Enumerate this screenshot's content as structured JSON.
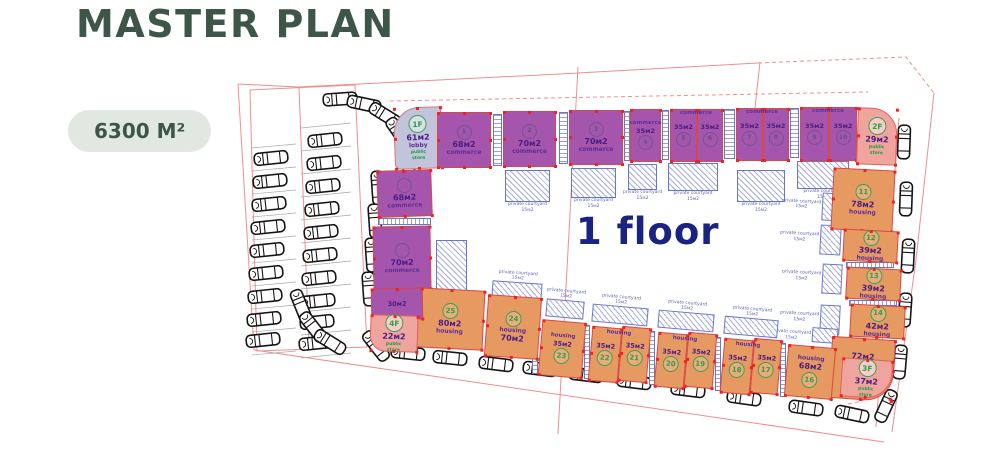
{
  "title": "MASTER PLAN",
  "area_badge": "6300 M²",
  "floor_label": "1 floor",
  "colors": {
    "title_green": "#3e5648",
    "badge_bg": "#e1e8e1",
    "commerce_purple": "#a655ad",
    "housing_orange": "#e69a61",
    "store_pink": "#f0a49e",
    "lobby_gray": "#c2c4dc",
    "circle_green": "#3aa24c",
    "plan_line_red": "#ef8f8f",
    "marker_red": "#ee2222",
    "courtyard_blue": "#6a76c8",
    "floor_text_blue": "#1b2380"
  },
  "plan": {
    "courtyard_label": "private courtyard",
    "courtyard_sub": "15м2",
    "units": [
      {
        "id": "lobby",
        "type": "lobby",
        "x": 394,
        "y": 107,
        "w": 48,
        "h": 62,
        "r": -2,
        "br": "26px 2px 2px 6px",
        "items": [
          [
            "1F",
            "circle-floor"
          ],
          [
            "61м2",
            "area"
          ],
          [
            "lobby",
            "use"
          ],
          [
            "public store",
            "store"
          ]
        ]
      },
      {
        "id": "c-left-68",
        "type": "commerce",
        "x": 377,
        "y": 170,
        "w": 55,
        "h": 47,
        "r": -2,
        "items": [
          [
            "",
            "circle-faint"
          ],
          [
            "68м2",
            "area"
          ],
          [
            "commerce",
            "use"
          ]
        ]
      },
      {
        "id": "c-left-70",
        "type": "commerce",
        "x": 373,
        "y": 226,
        "w": 58,
        "h": 64,
        "r": -1,
        "items": [
          [
            "",
            "circle-faint"
          ],
          [
            "70м2",
            "area"
          ],
          [
            "commerce",
            "use"
          ]
        ]
      },
      {
        "id": "c1",
        "type": "commerce",
        "x": 437,
        "y": 112,
        "w": 54,
        "h": 56,
        "items": [
          [
            "1",
            "circle-faint"
          ],
          [
            "68м2",
            "area"
          ],
          [
            "commerce",
            "use"
          ]
        ]
      },
      {
        "id": "c2",
        "type": "commerce",
        "x": 503,
        "y": 111,
        "w": 53,
        "h": 56,
        "items": [
          [
            "2",
            "circle-faint"
          ],
          [
            "70м2",
            "area"
          ],
          [
            "commerce",
            "use"
          ]
        ]
      },
      {
        "id": "c3",
        "type": "commerce",
        "x": 569,
        "y": 110,
        "w": 54,
        "h": 55,
        "items": [
          [
            "3",
            "circle-faint"
          ],
          [
            "70м2",
            "area"
          ],
          [
            "commerce",
            "use"
          ]
        ]
      },
      {
        "id": "c4",
        "type": "commerce",
        "x": 630,
        "y": 109,
        "w": 31,
        "h": 53,
        "items": [
          [
            "commerce",
            "use-sm"
          ],
          [
            "35м2",
            "area-sm"
          ],
          [
            "4",
            "circle-faint"
          ]
        ]
      },
      {
        "id": "c5",
        "type": "commerce",
        "x": 670,
        "y": 109,
        "w": 27,
        "h": 53,
        "items": [
          [
            "35м2",
            "area-sm"
          ],
          [
            "5",
            "circle-faint"
          ]
        ]
      },
      {
        "id": "c6",
        "type": "commerce",
        "x": 697,
        "y": 109,
        "w": 26,
        "h": 53,
        "items": [
          [
            "35м2",
            "area-sm"
          ],
          [
            "6",
            "circle-faint"
          ]
        ]
      },
      {
        "id": "c7",
        "type": "commerce",
        "x": 736,
        "y": 108,
        "w": 27,
        "h": 53,
        "items": [
          [
            "35м2",
            "area-sm"
          ],
          [
            "7",
            "circle-faint"
          ]
        ]
      },
      {
        "id": "c8",
        "type": "commerce",
        "x": 763,
        "y": 108,
        "w": 26,
        "h": 53,
        "items": [
          [
            "35м2",
            "area-sm"
          ],
          [
            "8",
            "circle-faint"
          ]
        ]
      },
      {
        "id": "c9",
        "type": "commerce",
        "x": 800,
        "y": 107,
        "w": 29,
        "h": 54,
        "items": [
          [
            "35м2",
            "area-sm"
          ],
          [
            "9",
            "circle-faint"
          ]
        ]
      },
      {
        "id": "c10",
        "type": "commerce",
        "x": 829,
        "y": 107,
        "w": 28,
        "h": 54,
        "items": [
          [
            "35м2",
            "area-sm"
          ],
          [
            "10",
            "circle-faint"
          ]
        ]
      },
      {
        "id": "store-2f",
        "type": "store",
        "x": 857,
        "y": 108,
        "w": 40,
        "h": 57,
        "r": 2,
        "br": "2px 26px 2px 2px",
        "items": [
          [
            "2F",
            "circle-floor"
          ],
          [
            "29м2",
            "area"
          ],
          [
            "public store",
            "store"
          ]
        ]
      },
      {
        "id": "h11",
        "type": "housing",
        "x": 832,
        "y": 169,
        "w": 62,
        "h": 62,
        "r": 3,
        "items": [
          [
            "11",
            "circle"
          ],
          [
            "78м2",
            "area"
          ],
          [
            "housing",
            "use"
          ]
        ]
      },
      {
        "id": "h12",
        "type": "housing",
        "x": 843,
        "y": 230,
        "w": 55,
        "h": 32,
        "r": 3,
        "items": [
          [
            "12",
            "circle"
          ],
          [
            "39м2",
            "area"
          ],
          [
            "housing",
            "use"
          ]
        ]
      },
      {
        "id": "h13",
        "type": "housing",
        "x": 846,
        "y": 268,
        "w": 55,
        "h": 32,
        "r": 3,
        "items": [
          [
            "13",
            "circle"
          ],
          [
            "39м2",
            "area"
          ],
          [
            "housing",
            "use"
          ]
        ]
      },
      {
        "id": "h14",
        "type": "housing",
        "x": 850,
        "y": 305,
        "w": 55,
        "h": 33,
        "r": 3,
        "items": [
          [
            "14",
            "circle"
          ],
          [
            "42м2",
            "area"
          ],
          [
            "housing",
            "use"
          ]
        ]
      },
      {
        "id": "h15",
        "type": "housing",
        "x": 830,
        "y": 338,
        "w": 64,
        "h": 62,
        "r": 4,
        "br": "2px 2px 28px 2px",
        "items": [
          [
            "72м2",
            "area"
          ],
          [
            "15",
            "circle"
          ],
          [
            "housing",
            "use"
          ]
        ]
      },
      {
        "id": "store-3f",
        "type": "store",
        "x": 841,
        "y": 359,
        "w": 51,
        "h": 39,
        "r": 4,
        "br": "2px 2px 26px 2px",
        "items": [
          [
            "3F",
            "circle-floor"
          ],
          [
            "37м2",
            "area"
          ],
          [
            "public store",
            "store"
          ]
        ]
      },
      {
        "id": "h16",
        "type": "housing",
        "x": 786,
        "y": 346,
        "w": 48,
        "h": 52,
        "r": 5,
        "items": [
          [
            "housing",
            "use"
          ],
          [
            "68м2",
            "area"
          ],
          [
            "16",
            "circle"
          ]
        ]
      },
      {
        "id": "h17",
        "type": "housing",
        "x": 752,
        "y": 339,
        "w": 28,
        "h": 55,
        "r": 5,
        "items": [
          [
            "35м2",
            "area-sm"
          ],
          [
            "17",
            "circle"
          ]
        ]
      },
      {
        "id": "h18",
        "type": "housing",
        "x": 722,
        "y": 339,
        "w": 30,
        "h": 55,
        "r": 5,
        "items": [
          [
            "35м2",
            "area-sm"
          ],
          [
            "18",
            "circle"
          ]
        ]
      },
      {
        "id": "h19",
        "type": "housing",
        "x": 686,
        "y": 333,
        "w": 29,
        "h": 55,
        "r": 5,
        "items": [
          [
            "35м2",
            "area-sm"
          ],
          [
            "19",
            "circle"
          ]
        ]
      },
      {
        "id": "h20",
        "type": "housing",
        "x": 656,
        "y": 333,
        "w": 30,
        "h": 55,
        "r": 5,
        "items": [
          [
            "35м2",
            "area-sm"
          ],
          [
            "20",
            "circle"
          ]
        ]
      },
      {
        "id": "h21",
        "type": "housing",
        "x": 620,
        "y": 327,
        "w": 29,
        "h": 55,
        "r": 5,
        "items": [
          [
            "35м2",
            "area-sm"
          ],
          [
            "21",
            "circle"
          ]
        ]
      },
      {
        "id": "h22",
        "type": "housing",
        "x": 590,
        "y": 327,
        "w": 30,
        "h": 55,
        "r": 5,
        "items": [
          [
            "35м2",
            "area-sm"
          ],
          [
            "22",
            "circle"
          ]
        ]
      },
      {
        "id": "h23",
        "type": "housing",
        "x": 540,
        "y": 321,
        "w": 44,
        "h": 56,
        "r": 5,
        "items": [
          [
            "housing",
            "use-sm"
          ],
          [
            "35м2",
            "area-sm"
          ],
          [
            "23",
            "circle"
          ]
        ]
      },
      {
        "id": "h24",
        "type": "housing",
        "x": 486,
        "y": 296,
        "w": 54,
        "h": 62,
        "r": 4,
        "items": [
          [
            "24",
            "circle"
          ],
          [
            "housing",
            "use"
          ],
          [
            "70м2",
            "area"
          ]
        ]
      },
      {
        "id": "h25",
        "type": "housing",
        "x": 416,
        "y": 289,
        "w": 68,
        "h": 60,
        "r": 3,
        "items": [
          [
            "25",
            "circle"
          ],
          [
            "80м2",
            "area"
          ],
          [
            "housing",
            "use"
          ]
        ]
      },
      {
        "id": "c-left-30",
        "type": "commerce",
        "x": 371,
        "y": 288,
        "w": 52,
        "h": 32,
        "r": -1,
        "items": [
          [
            "30м2",
            "area-sm"
          ]
        ]
      },
      {
        "id": "store-4f",
        "type": "store",
        "x": 370,
        "y": 315,
        "w": 48,
        "h": 37,
        "r": 2,
        "br": "2px 2px 2px 16px",
        "items": [
          [
            "4F",
            "circle-floor"
          ],
          [
            "22м2",
            "area"
          ],
          [
            "public store",
            "store"
          ]
        ]
      }
    ],
    "labels": [
      {
        "t": "commerce",
        "x": 696,
        "y": 110,
        "r": 0,
        "cls": "use-sm"
      },
      {
        "t": "commerce",
        "x": 762,
        "y": 109,
        "r": 0,
        "cls": "use-sm"
      },
      {
        "t": "commerce",
        "x": 828,
        "y": 108,
        "r": 0,
        "cls": "use-sm"
      },
      {
        "t": "housing",
        "x": 619,
        "y": 330,
        "r": 5,
        "cls": "use-sm"
      },
      {
        "t": "housing",
        "x": 685,
        "y": 336,
        "r": 5,
        "cls": "use-sm"
      },
      {
        "t": "housing",
        "x": 748,
        "y": 342,
        "r": 5,
        "cls": "use-sm"
      }
    ],
    "courtyards": [
      {
        "x": 436,
        "y": 240,
        "w": 31,
        "h": 56,
        "r": 0,
        "pos": "below"
      },
      {
        "x": 505,
        "y": 170,
        "w": 45,
        "h": 32,
        "r": 0,
        "pos": "below"
      },
      {
        "x": 571,
        "y": 168,
        "w": 45,
        "h": 30,
        "r": 0,
        "pos": "below"
      },
      {
        "x": 628,
        "y": 164,
        "w": 29,
        "h": 26,
        "r": 0,
        "pos": "below"
      },
      {
        "x": 668,
        "y": 163,
        "w": 50,
        "h": 28,
        "r": 0,
        "pos": "below"
      },
      {
        "x": 737,
        "y": 170,
        "w": 48,
        "h": 32,
        "r": 0,
        "pos": "below"
      },
      {
        "x": 797,
        "y": 161,
        "w": 52,
        "h": 28,
        "r": 0,
        "pos": "below"
      },
      {
        "x": 822,
        "y": 193,
        "w": 22,
        "h": 28,
        "r": 3,
        "pos": "left"
      },
      {
        "x": 820,
        "y": 225,
        "w": 21,
        "h": 30,
        "r": 3,
        "pos": "left"
      },
      {
        "x": 822,
        "y": 264,
        "w": 20,
        "h": 30,
        "r": 3,
        "pos": "left"
      },
      {
        "x": 820,
        "y": 305,
        "w": 20,
        "h": 30,
        "r": 3,
        "pos": "left"
      },
      {
        "x": 812,
        "y": 328,
        "w": 26,
        "h": 15,
        "r": 4,
        "pos": "left"
      },
      {
        "x": 492,
        "y": 282,
        "w": 50,
        "h": 16,
        "r": 4,
        "pos": "above"
      },
      {
        "x": 546,
        "y": 300,
        "w": 38,
        "h": 18,
        "r": 5,
        "pos": "above"
      },
      {
        "x": 592,
        "y": 306,
        "w": 56,
        "h": 18,
        "r": 5,
        "pos": "above"
      },
      {
        "x": 658,
        "y": 312,
        "w": 56,
        "h": 18,
        "r": 5,
        "pos": "above"
      },
      {
        "x": 724,
        "y": 318,
        "w": 54,
        "h": 18,
        "r": 5,
        "pos": "above"
      }
    ],
    "stairs": [
      {
        "x": 493,
        "y": 114,
        "w": 9,
        "h": 52
      },
      {
        "x": 559,
        "y": 112,
        "w": 9,
        "h": 52
      },
      {
        "x": 624,
        "y": 111,
        "w": 6,
        "h": 50
      },
      {
        "x": 662,
        "y": 110,
        "w": 7,
        "h": 50
      },
      {
        "x": 724,
        "y": 109,
        "w": 11,
        "h": 50
      },
      {
        "x": 790,
        "y": 108,
        "w": 9,
        "h": 50
      },
      {
        "x": 378,
        "y": 218,
        "w": 53,
        "h": 7,
        "horiz": true
      },
      {
        "x": 846,
        "y": 262,
        "w": 48,
        "h": 6,
        "horiz": true
      },
      {
        "x": 849,
        "y": 300,
        "w": 48,
        "h": 6,
        "horiz": true
      },
      {
        "x": 532,
        "y": 320,
        "w": 6,
        "h": 54
      },
      {
        "x": 584,
        "y": 325,
        "w": 6,
        "h": 54
      },
      {
        "x": 649,
        "y": 331,
        "w": 6,
        "h": 54
      },
      {
        "x": 715,
        "y": 337,
        "w": 6,
        "h": 54
      },
      {
        "x": 780,
        "y": 343,
        "w": 6,
        "h": 54
      }
    ],
    "roads": [
      {
        "d": "M238,84 L254,350",
        "dash": false
      },
      {
        "d": "M254,350 L884,442",
        "dash": false
      },
      {
        "d": "M298,87 L560,74 L758,63",
        "dash": false
      },
      {
        "d": "M758,63 L906,57 L934,93",
        "dash": true
      },
      {
        "d": "M934,93 L916,260 L892,432",
        "dash": false
      },
      {
        "d": "M390,101 L868,92",
        "dash": true
      },
      {
        "d": "M238,84 L298,87",
        "dash": false
      },
      {
        "d": "M578,67 L558,434",
        "dash": false
      },
      {
        "d": "M760,62 L753,126",
        "dash": false
      },
      {
        "d": "M848,404 Q886,398 897,368",
        "dash": true
      },
      {
        "d": "M899,118 L876,427",
        "dash": false
      },
      {
        "d": "M299,88 L309,346",
        "dash": false
      },
      {
        "d": "M250,90 L355,85 L367,347 L257,351 Z",
        "dash": false
      }
    ],
    "stalls": [
      {
        "x1": 252,
        "y1": 148,
        "x2": 296,
        "y2": 144,
        "step": 23,
        "n": 10
      },
      {
        "x1": 301,
        "y1": 128,
        "x2": 351,
        "y2": 123,
        "step": 23,
        "n": 11
      }
    ],
    "cars": [
      [
        271,
        158,
        -6
      ],
      [
        270,
        181,
        -6
      ],
      [
        269,
        204,
        -6
      ],
      [
        268,
        227,
        -6
      ],
      [
        267,
        250,
        -6
      ],
      [
        266,
        273,
        -6
      ],
      [
        265,
        296,
        -6
      ],
      [
        264,
        319,
        -6
      ],
      [
        263,
        340,
        -6
      ],
      [
        325,
        140,
        -6
      ],
      [
        324,
        163,
        -6
      ],
      [
        323,
        186,
        -6
      ],
      [
        322,
        209,
        -6
      ],
      [
        321,
        232,
        -6
      ],
      [
        320,
        255,
        -6
      ],
      [
        319,
        278,
        -6
      ],
      [
        318,
        301,
        -6
      ],
      [
        317,
        322,
        -6
      ],
      [
        316,
        343,
        -6
      ],
      [
        340,
        99,
        -4
      ],
      [
        364,
        104,
        12
      ],
      [
        385,
        115,
        32
      ],
      [
        399,
        133,
        55
      ],
      [
        406,
        156,
        76
      ],
      [
        378,
        188,
        86
      ],
      [
        375,
        221,
        86
      ],
      [
        372,
        255,
        86
      ],
      [
        369,
        289,
        86
      ],
      [
        301,
        306,
        68
      ],
      [
        313,
        327,
        52
      ],
      [
        330,
        342,
        32
      ],
      [
        904,
        142,
        92
      ],
      [
        906,
        199,
        92
      ],
      [
        908,
        256,
        93
      ],
      [
        905,
        310,
        94
      ],
      [
        900,
        362,
        95
      ],
      [
        886,
        406,
        115
      ],
      [
        408,
        353,
        6
      ],
      [
        450,
        358,
        6
      ],
      [
        496,
        364,
        7
      ],
      [
        540,
        369,
        7
      ],
      [
        586,
        375,
        7
      ],
      [
        634,
        382,
        7
      ],
      [
        688,
        390,
        7
      ],
      [
        744,
        398,
        8
      ],
      [
        806,
        408,
        8
      ],
      [
        852,
        414,
        12
      ],
      [
        376,
        346,
        52
      ]
    ]
  }
}
